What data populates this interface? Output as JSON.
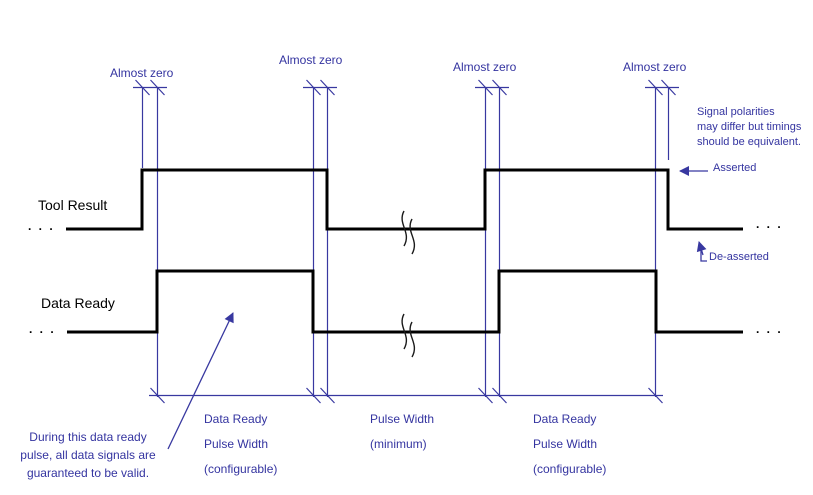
{
  "colors": {
    "annotation_blue": "#3434a0",
    "waveform_black": "#000000",
    "background": "#ffffff"
  },
  "labels": {
    "almost_zero": "Almost zero",
    "ellipsis": ". . ."
  },
  "signals": [
    {
      "label": "Tool Result"
    },
    {
      "label": "Data Ready"
    }
  ],
  "waveform_description": {
    "tool_result": "low, high pulse, low interval with time-break marks, second high pulse, low",
    "data_ready": "low, high pulse nested just inside the Tool Result pulse, low interval with time-break marks, second nested high pulse, low",
    "edge_relations": "Each Data Ready edge occurs an 'Almost zero' delay inside the corresponding Tool Result edge"
  },
  "notes": {
    "polarity": {
      "lines": [
        "Signal polarities",
        "may differ but timings",
        "should be equivalent."
      ]
    },
    "asserted": "Asserted",
    "de_asserted": "De-asserted",
    "during": {
      "lines": [
        "During this data ready",
        "pulse, all data signals are",
        "guaranteed to be valid."
      ]
    }
  },
  "dimensions": [
    {
      "lines": [
        "Data Ready",
        "Pulse Width",
        "(configurable)"
      ]
    },
    {
      "lines": [
        "Pulse Width",
        "(minimum)"
      ]
    },
    {
      "lines": [
        "Data Ready",
        "Pulse Width",
        "(configurable)"
      ]
    }
  ]
}
